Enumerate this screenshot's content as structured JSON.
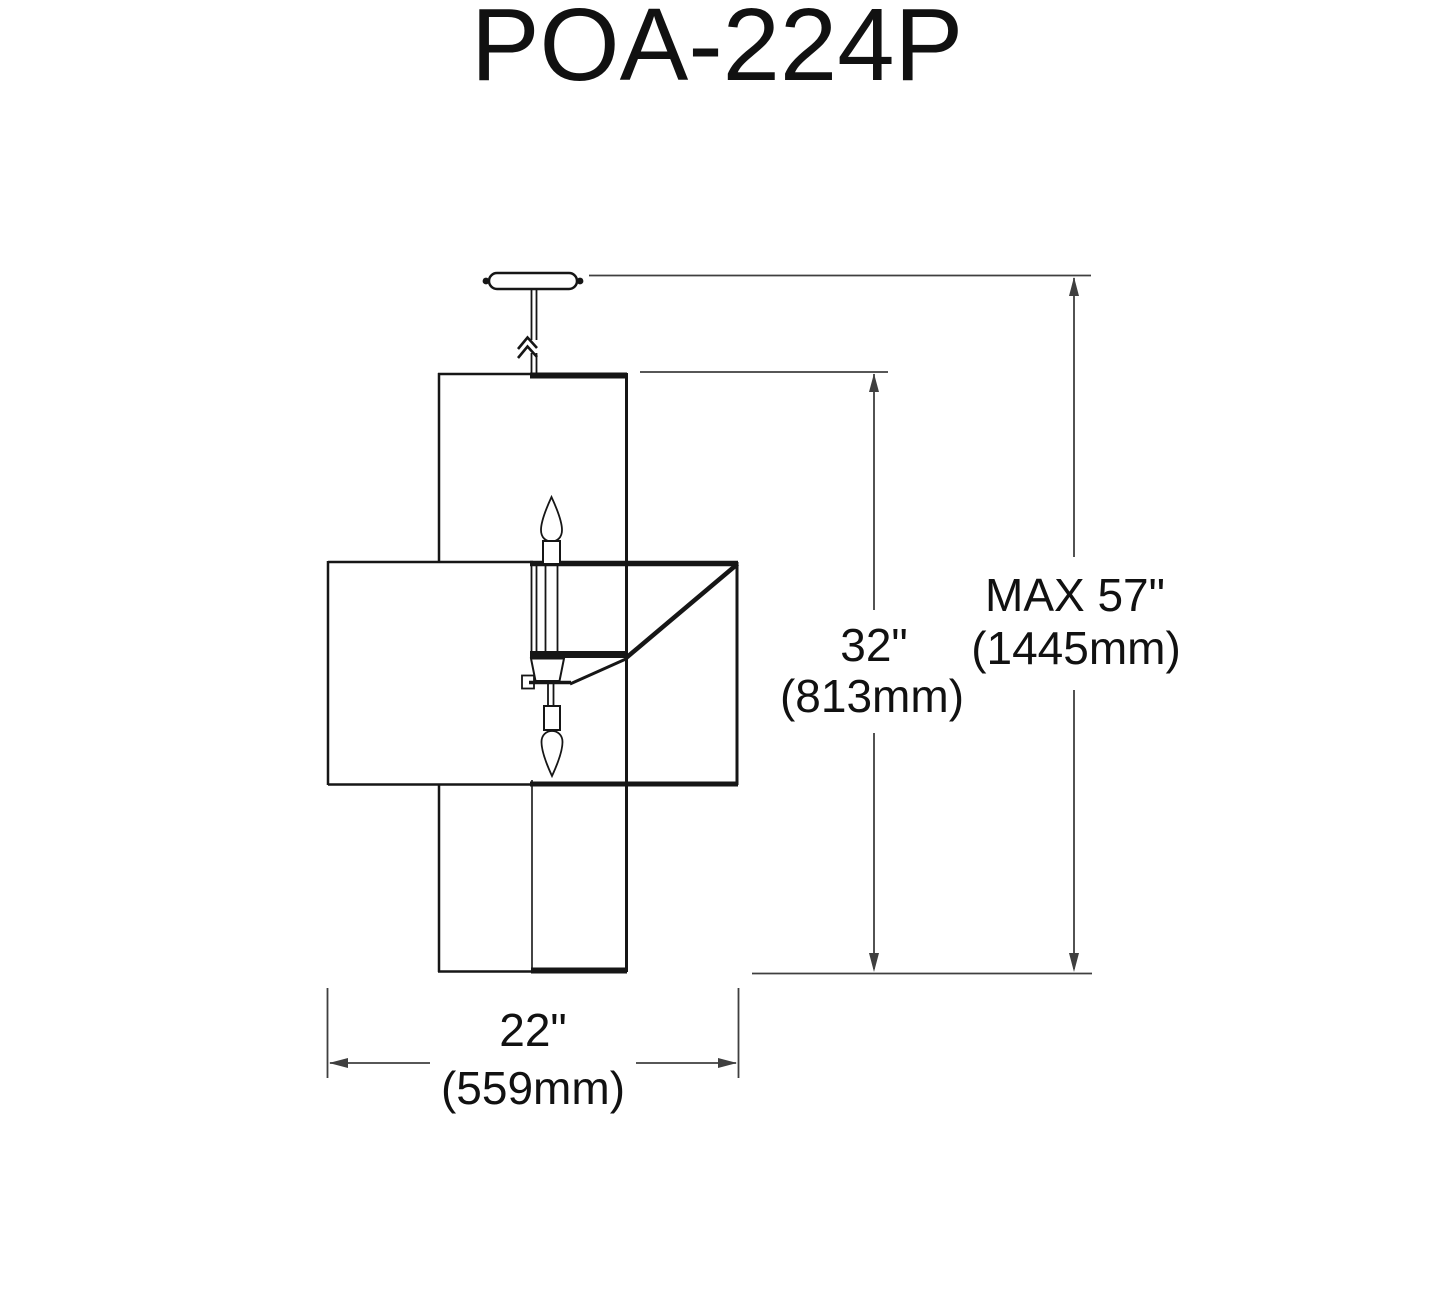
{
  "title": "POA-224P",
  "drawing": {
    "kind": "pendant-light dimension line drawing",
    "parts": {
      "canopy": "ceiling canopy with mounting screws",
      "rod": "hanging rod with length-break symbol",
      "vertical_shade": "tall rectangular shade",
      "horizontal_shade": "wide rectangular shade with corner support arm",
      "cluster": "center candelabra cluster with up and down candle bulbs"
    }
  },
  "dimensions": {
    "overall_height": {
      "in": "MAX 57\"",
      "mm": "(1445mm)"
    },
    "shade_height": {
      "in": "32\"",
      "mm": "(813mm)"
    },
    "shade_width": {
      "in": "22\"",
      "mm": "(559mm)"
    }
  },
  "colors": {
    "object_line": "#161616",
    "dimension_line": "#3f3f3f",
    "text": "#111111",
    "background": "#ffffff"
  }
}
